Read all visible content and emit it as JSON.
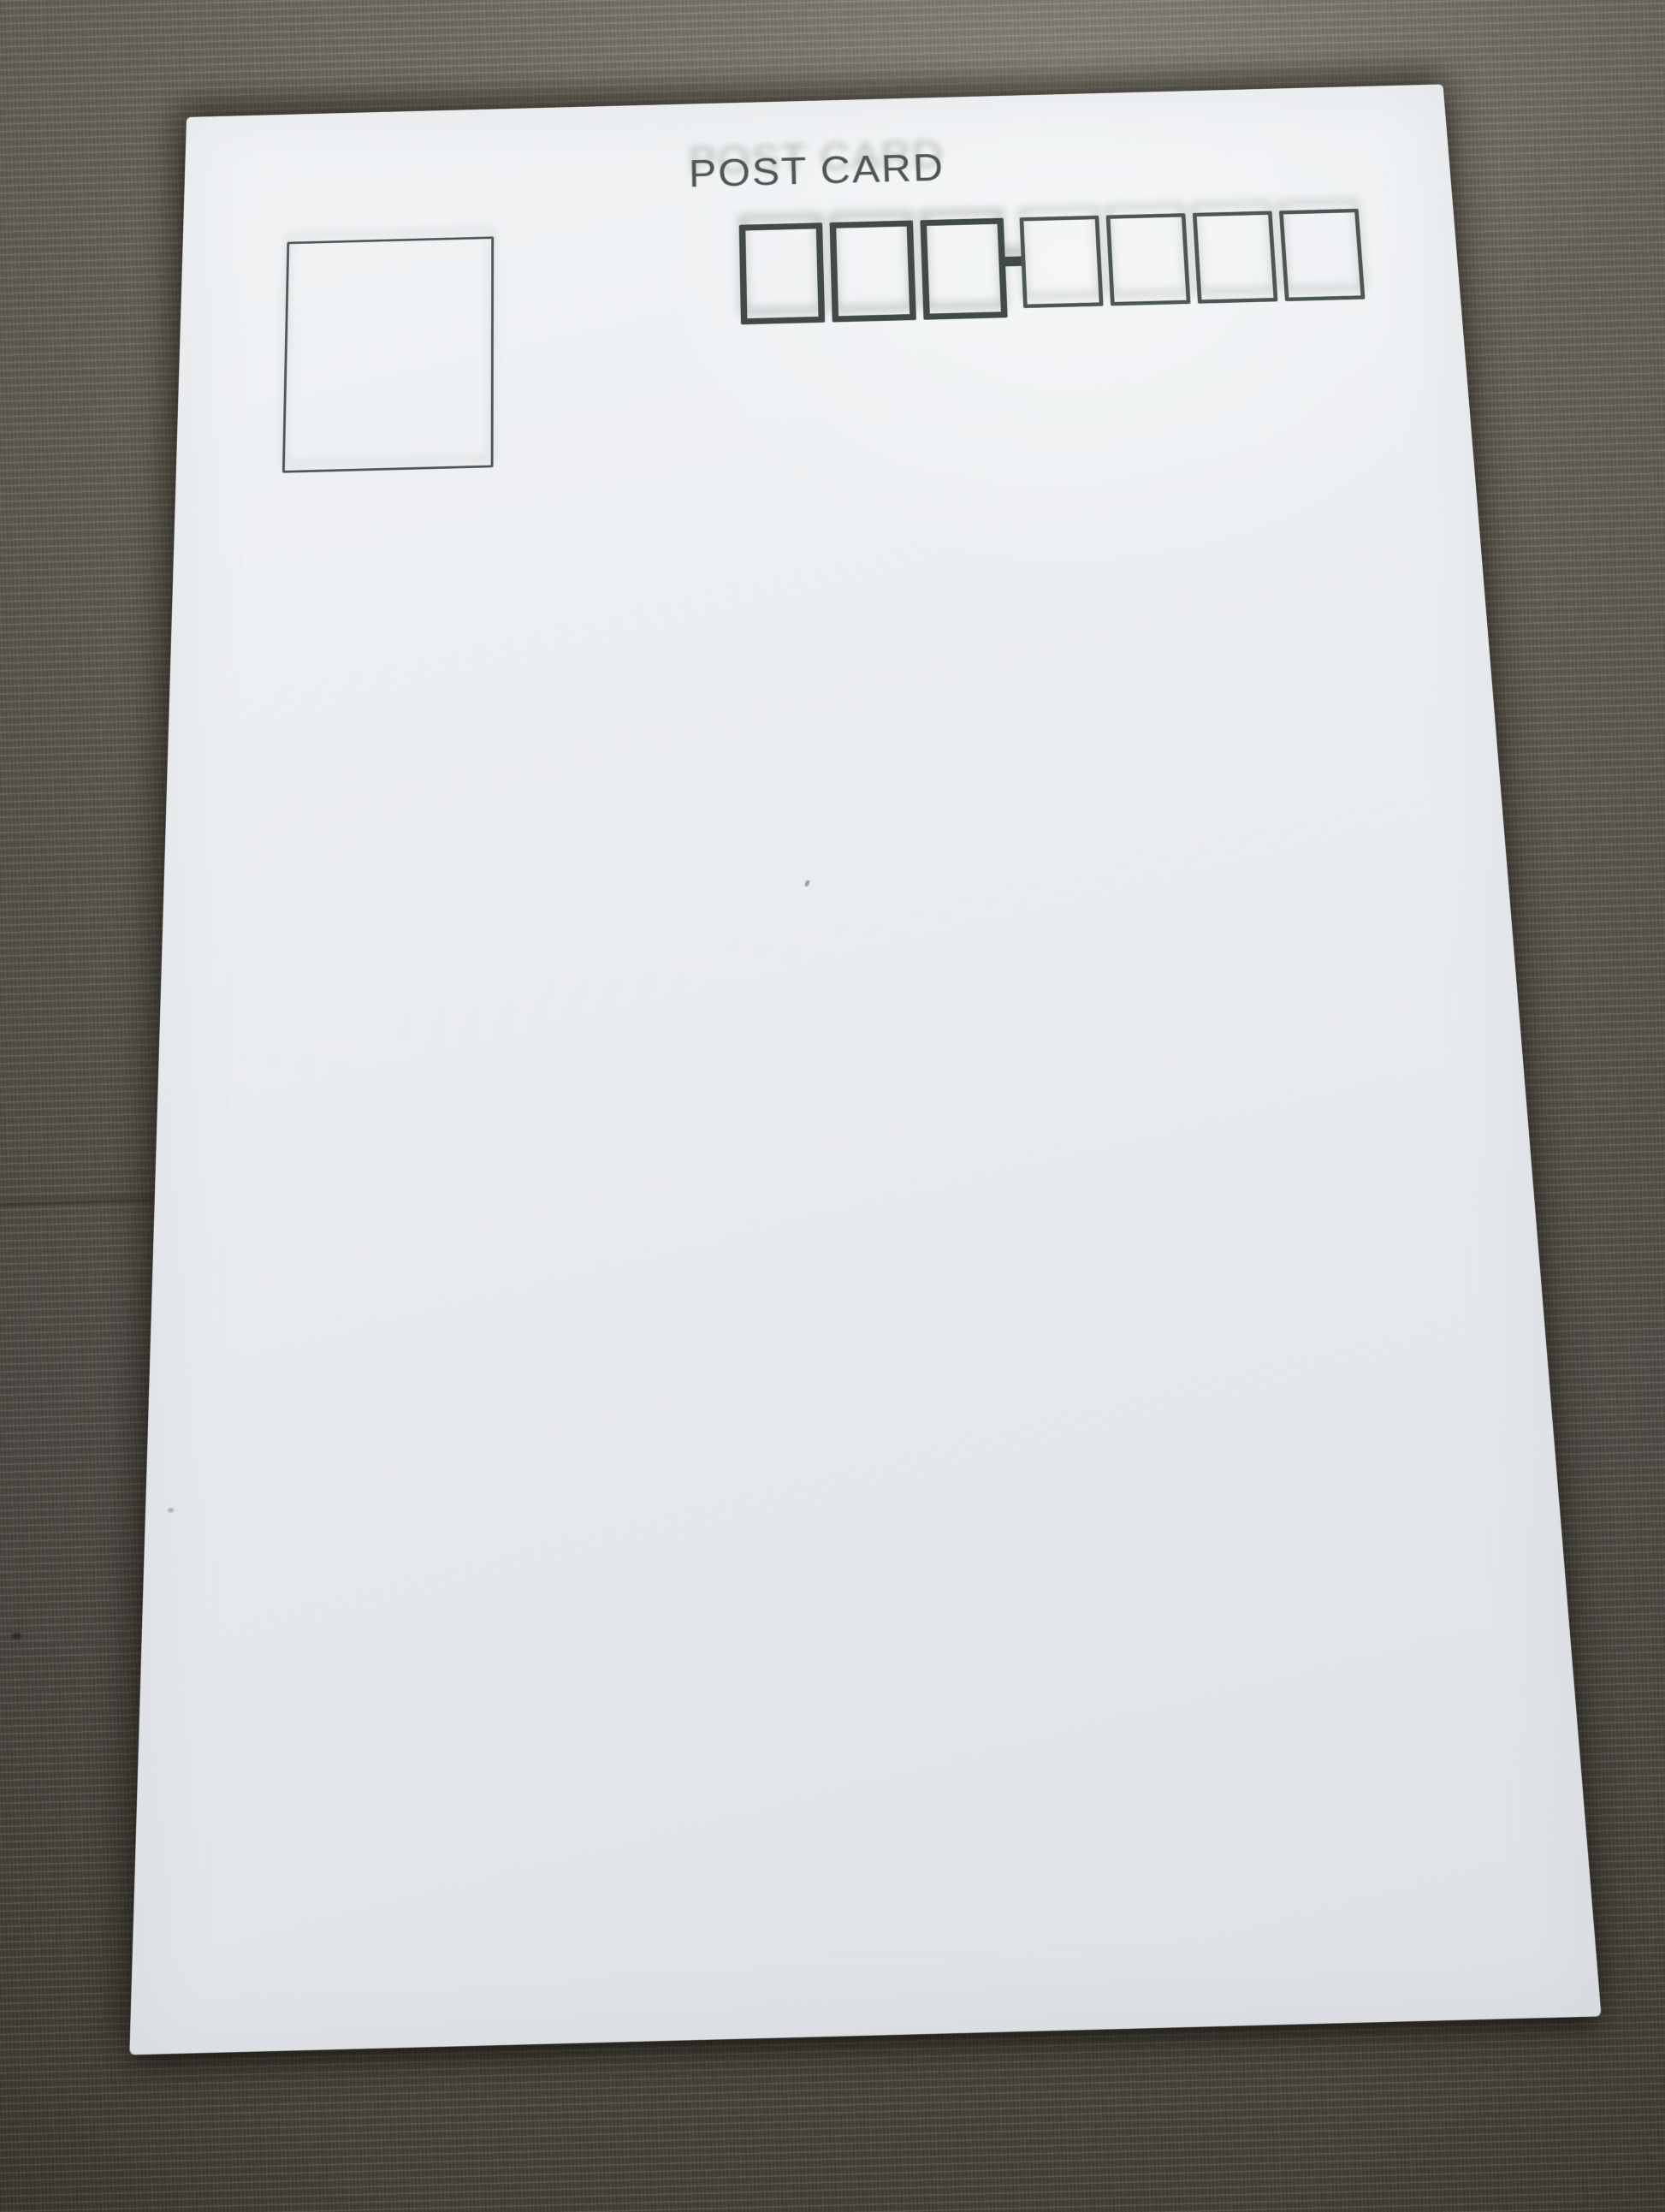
{
  "scene": {
    "type": "photograph",
    "description": "Blank address side of a white Japanese-style postcard lying on olive-gray woven fabric"
  },
  "colors": {
    "ink": "#404b47",
    "ink-light": "#4c5653",
    "card": "#eaedf0",
    "fabric-top": "#6f6a60",
    "fabric-bottom": "#443f36"
  },
  "postcard": {
    "title": "POST CARD",
    "stamp_box": {
      "present": true
    },
    "postal_code": {
      "group1_count": 3,
      "group2_count": 4,
      "separator": "-"
    }
  }
}
